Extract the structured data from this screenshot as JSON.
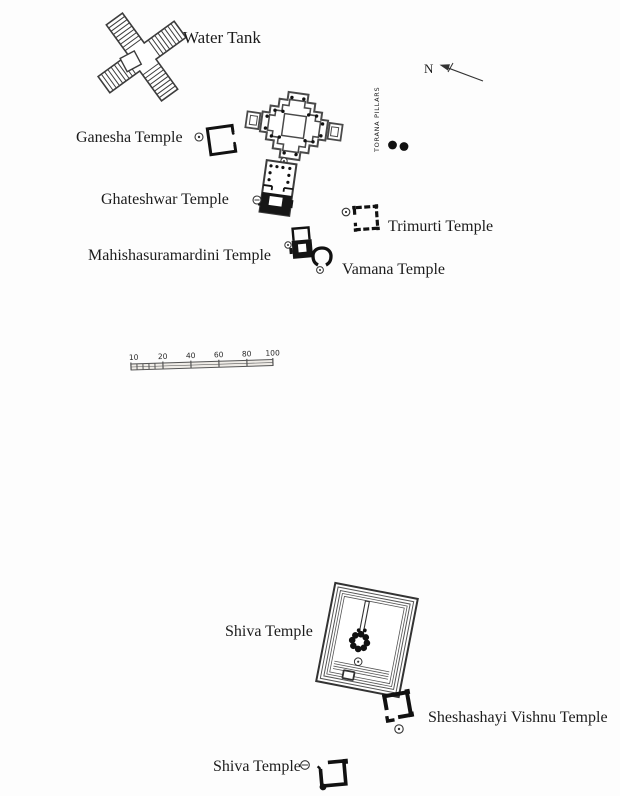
{
  "page": {
    "background_color": "#fdfdfd",
    "ink_color": "#1c1c1c",
    "line_color": "#3c3c3c"
  },
  "map": {
    "labels": {
      "water_tank": "Water Tank",
      "ganesha_temple": "Ganesha Temple",
      "ghateshwar_temple": "Ghateshwar Temple",
      "mahishasuramardini_temple": "Mahishasuramardini Temple",
      "trimurti_temple": "Trimurti Temple",
      "vamana_temple": "Vamana Temple",
      "torana_pillars": "TORANA PILLARS",
      "shiva_temple_main": "Shiva Temple",
      "sheshashayi_vishnu_temple": "Sheshashayi Vishnu Temple",
      "shiva_temple_south": "Shiva Temple",
      "north_indicator": "N"
    },
    "torana_pillar_dot_count": 2,
    "scale_bar": {
      "unit_ticks": [
        "10",
        "20",
        "40",
        "60",
        "80",
        "100"
      ]
    }
  }
}
